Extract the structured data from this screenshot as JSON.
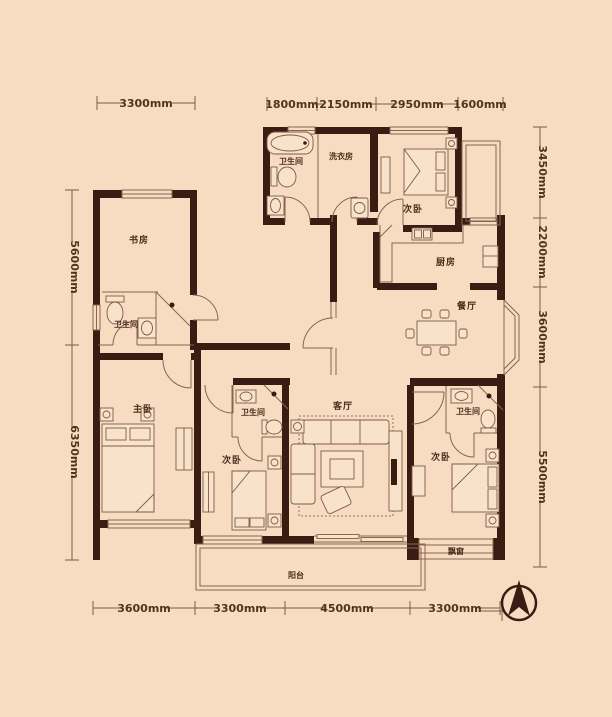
{
  "plan_title": "apartment-floor-plan",
  "rooms": {
    "study": "书房",
    "bath_left": "卫生间",
    "master": "主卧",
    "bath_top": "卫生间",
    "laundry": "洗衣房",
    "bedroom_top": "次卧",
    "kitchen": "厨房",
    "dining": "餐厅",
    "living": "客厅",
    "bedroom_mid": "次卧",
    "bath_mid": "卫生间",
    "bedroom_right": "次卧",
    "bath_right": "卫生间",
    "balcony": "阳台",
    "bay_window": "飘窗"
  },
  "dimensions": {
    "top_left": "3300mm",
    "top": [
      "1800mm",
      "2150mm",
      "2950mm",
      "1600mm"
    ],
    "left": [
      "5600mm",
      "6350mm"
    ],
    "right": [
      "3450mm",
      "2200mm",
      "3600mm",
      "5500mm"
    ],
    "bottom": [
      "3600mm",
      "3300mm",
      "4500mm",
      "3300mm"
    ]
  },
  "compass": {
    "icon": "north-arrow"
  },
  "colors": {
    "background": "#f8dcc2",
    "wall": "#3a1c13",
    "line": "#8a6450",
    "dim_text": "#53321f",
    "room_text": "#4b2b1a"
  }
}
